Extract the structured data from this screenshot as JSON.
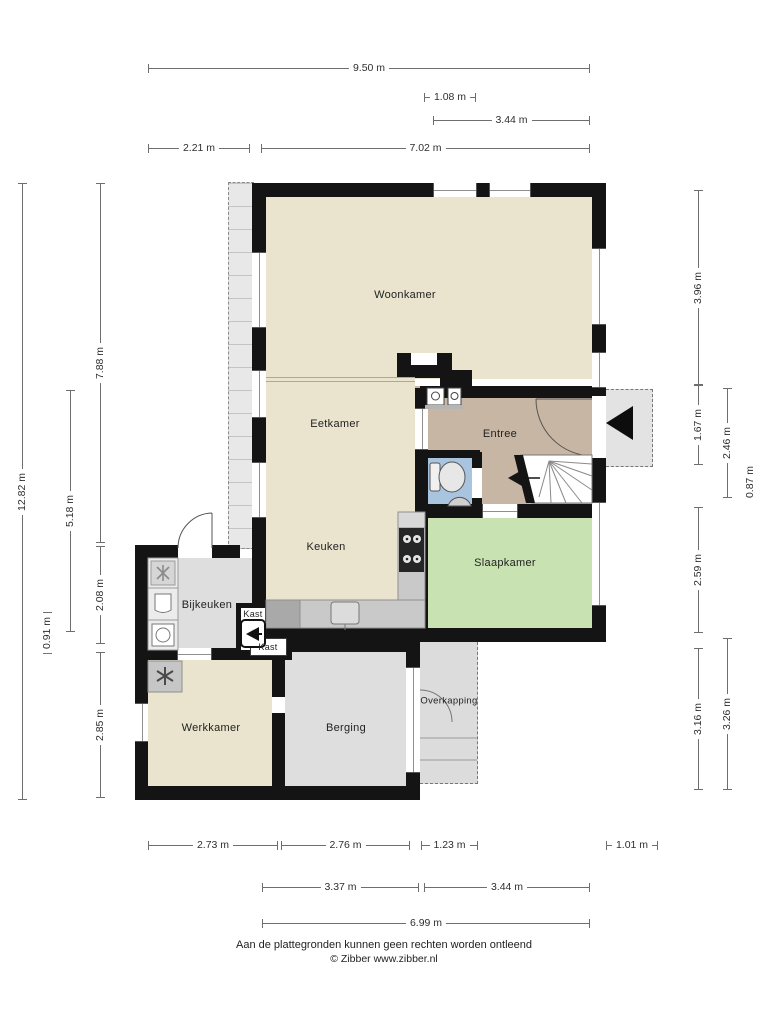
{
  "rooms": {
    "woonkamer": "Woonkamer",
    "eetkamer": "Eetkamer",
    "keuken": "Keuken",
    "entree": "Entree",
    "slaapkamer": "Slaapkamer",
    "bijkeuken": "Bijkeuken",
    "kast1": "Kast",
    "kast2": "Kast",
    "werkkamer": "Werkkamer",
    "berging": "Berging",
    "overkapping": "Overkapping"
  },
  "dimensions": {
    "top": {
      "d950": "9.50 m",
      "d108": "1.08 m",
      "d344": "3.44 m",
      "d221": "2.21 m",
      "d702": "7.02 m"
    },
    "bottom": {
      "d273": "2.73 m",
      "d276": "2.76 m",
      "d123": "1.23 m",
      "d101": "1.01 m",
      "d337": "3.37 m",
      "d344": "3.44 m",
      "d699": "6.99 m"
    },
    "left": {
      "d1282": "12.82 m",
      "d091": "0.91 m",
      "d518": "5.18 m",
      "d788": "7.88 m",
      "d208": "2.08 m",
      "d285": "2.85 m"
    },
    "right": {
      "d396": "3.96 m",
      "d167": "1.67 m",
      "d259": "2.59 m",
      "d316": "3.16 m",
      "d246": "2.46 m",
      "d326": "3.26 m",
      "d087": "0.87 m"
    }
  },
  "footer": {
    "disclaimer": "Aan de plattegronden kunnen geen rechten worden ontleend",
    "copyright": "© Zibber www.zibber.nl"
  },
  "colors": {
    "wall": "#141414",
    "floor_beige": "#eae3cd",
    "floor_brown": "#c7b6a4",
    "floor_green": "#c9e2b2",
    "floor_blue": "#a9c4de",
    "floor_gray": "#dedede",
    "counter_gray": "#c9c9c9"
  }
}
